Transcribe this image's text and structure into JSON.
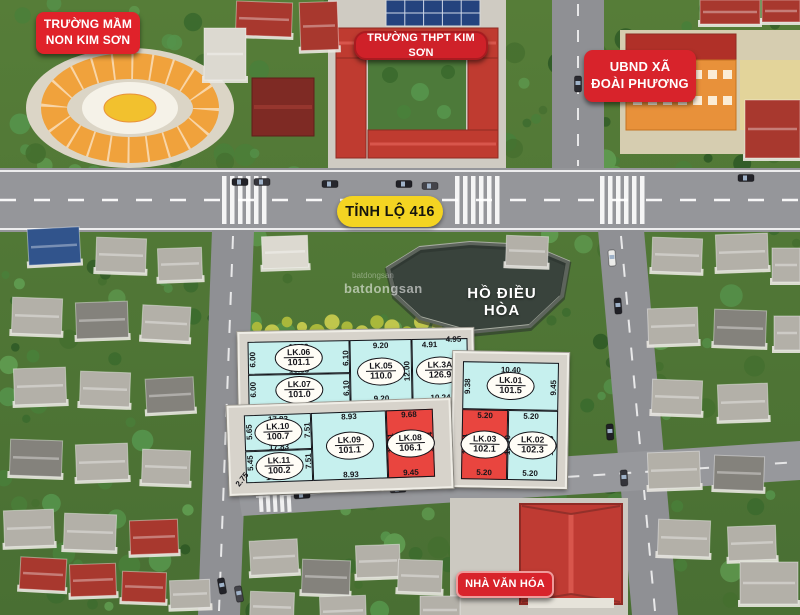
{
  "labels": {
    "kindergarten": {
      "line1": "TRƯỜNG MẦM",
      "line2": "NON KIM SƠN"
    },
    "school": {
      "text": "TRƯỜNG THPT KIM SƠN"
    },
    "ubnd": {
      "line1": "UBND XÃ",
      "line2": "ĐOÀI PHƯƠNG"
    },
    "road": {
      "text": "TỈNH LỘ 416"
    },
    "lake": {
      "text": "HỒ ĐIỀU HÒA"
    },
    "culture_house": {
      "text": "NHÀ VĂN HÓA"
    }
  },
  "watermark": {
    "text": "batdongsan"
  },
  "colors": {
    "label_red": "#d8232b",
    "road_yellow": "#f4d422",
    "plot_cyan": "#c6f0ee",
    "plot_red": "#e9453f",
    "lake_water": "#39433c",
    "platform_gray": "#d7d3cb"
  },
  "map": {
    "blocks": [
      {
        "id": "A",
        "platform": {
          "x": 238,
          "y": 330,
          "w": 232,
          "h": 77,
          "rot": -1
        },
        "plots": [
          {
            "code": "LK.06",
            "area": "101.1",
            "fill": "cyan",
            "x": 8,
            "y": 8,
            "w": 102,
            "h": 33
          },
          {
            "code": "LK.07",
            "area": "101.0",
            "fill": "cyan",
            "x": 8,
            "y": 41,
            "w": 102,
            "h": 31
          },
          {
            "code": "LK.05",
            "area": "110.0",
            "fill": "cyan",
            "x": 110,
            "y": 8,
            "w": 62,
            "h": 64
          },
          {
            "code": "LK.3A",
            "area": "126.9",
            "fill": "cyan",
            "x": 172,
            "y": 8,
            "w": 56,
            "h": 64
          }
        ],
        "dims": [
          {
            "t": "16.89",
            "x": 59,
            "y": 14
          },
          {
            "t": "16.88",
            "x": 59,
            "y": 37
          },
          {
            "t": "16.89",
            "x": 59,
            "y": 67
          },
          {
            "t": "9.20",
            "x": 141,
            "y": 14
          },
          {
            "t": "9.20",
            "x": 141,
            "y": 67
          },
          {
            "t": "4.91",
            "x": 190,
            "y": 14
          },
          {
            "t": "4.95",
            "x": 214,
            "y": 9
          },
          {
            "t": "10.24",
            "x": 200,
            "y": 67
          },
          {
            "t": "6.00",
            "x": 13,
            "y": 26,
            "rot": -90
          },
          {
            "t": "6.00",
            "x": 13,
            "y": 56,
            "rot": -90
          },
          {
            "t": "6.10",
            "x": 106,
            "y": 26,
            "rot": -90
          },
          {
            "t": "6.10",
            "x": 106,
            "y": 56,
            "rot": -90
          },
          {
            "t": "12.00",
            "x": 167,
            "y": 40,
            "rot": -90
          },
          {
            "t": "13.08",
            "x": 222,
            "y": 40,
            "rot": -90
          }
        ]
      },
      {
        "id": "B",
        "platform": {
          "x": 452,
          "y": 352,
          "w": 112,
          "h": 132,
          "rot": 1
        },
        "plots": [
          {
            "code": "LK.01",
            "area": "101.5",
            "fill": "cyan",
            "x": 8,
            "y": 8,
            "w": 96,
            "h": 48
          },
          {
            "code": "LK.03",
            "area": "102.1",
            "fill": "red",
            "x": 8,
            "y": 56,
            "w": 46,
            "h": 70
          },
          {
            "code": "LK.02",
            "area": "102.3",
            "fill": "cyan",
            "x": 54,
            "y": 56,
            "w": 50,
            "h": 70
          }
        ],
        "dims": [
          {
            "t": "10.40",
            "x": 56,
            "y": 16
          },
          {
            "t": "9.38",
            "x": 13,
            "y": 33,
            "rot": -90
          },
          {
            "t": "9.45",
            "x": 99,
            "y": 33,
            "rot": -90
          },
          {
            "t": "5.20",
            "x": 31,
            "y": 62
          },
          {
            "t": "5.20",
            "x": 77,
            "y": 62
          },
          {
            "t": "5.20",
            "x": 31,
            "y": 119
          },
          {
            "t": "5.20",
            "x": 77,
            "y": 119
          },
          {
            "t": "19.64",
            "x": 12,
            "y": 91,
            "rot": -90
          },
          {
            "t": "19.70",
            "x": 54,
            "y": 91,
            "rot": -90
          },
          {
            "t": "19.76",
            "x": 97,
            "y": 91,
            "rot": -90
          }
        ]
      },
      {
        "id": "C",
        "platform": {
          "x": 228,
          "y": 402,
          "w": 220,
          "h": 86,
          "rot": -2
        },
        "plots": [
          {
            "code": "LK.10",
            "area": "100.7",
            "fill": "cyan",
            "x": 15,
            "y": 8,
            "w": 67,
            "h": 36
          },
          {
            "code": "LK.11",
            "area": "100.2",
            "fill": "cyan",
            "x": 15,
            "y": 44,
            "w": 67,
            "h": 32
          },
          {
            "code": "LK.09",
            "area": "101.1",
            "fill": "cyan",
            "x": 82,
            "y": 8,
            "w": 75,
            "h": 68
          },
          {
            "code": "LK.08",
            "area": "106.1",
            "fill": "red",
            "x": 157,
            "y": 8,
            "w": 47,
            "h": 68
          }
        ],
        "dims": [
          {
            "t": "17.83",
            "x": 49,
            "y": 13
          },
          {
            "t": "17.83",
            "x": 49,
            "y": 41
          },
          {
            "t": "14.02",
            "x": 45,
            "y": 71
          },
          {
            "t": "8.93",
            "x": 120,
            "y": 13
          },
          {
            "t": "8.93",
            "x": 120,
            "y": 71
          },
          {
            "t": "9.68",
            "x": 180,
            "y": 13
          },
          {
            "t": "9.45",
            "x": 180,
            "y": 71
          },
          {
            "t": "5.65",
            "x": 20,
            "y": 25,
            "rot": -90
          },
          {
            "t": "5.45",
            "x": 20,
            "y": 56,
            "rot": -90
          },
          {
            "t": "2.75",
            "x": 11,
            "y": 72,
            "rot": -50
          },
          {
            "t": "7.51",
            "x": 78,
            "y": 25,
            "rot": -90
          },
          {
            "t": "7.51",
            "x": 78,
            "y": 56,
            "rot": -90
          },
          {
            "t": "11.31",
            "x": 161,
            "y": 41,
            "rot": -90
          },
          {
            "t": "10.74",
            "x": 200,
            "y": 41,
            "rot": -90
          }
        ]
      }
    ]
  }
}
